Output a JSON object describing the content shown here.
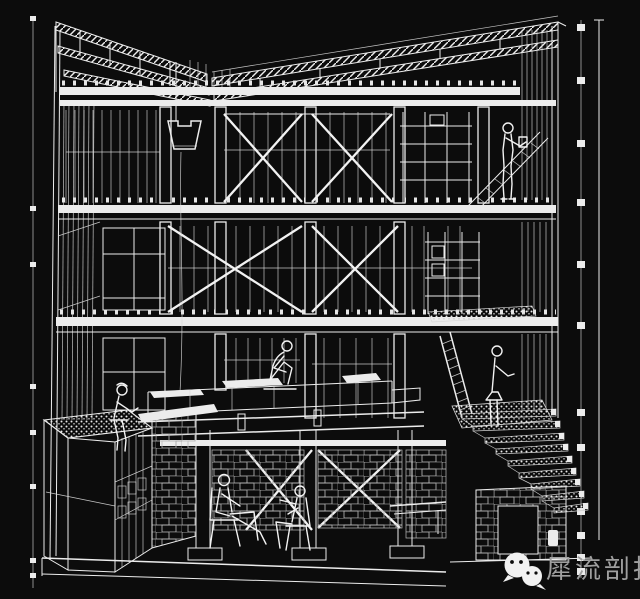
{
  "page": {
    "background_color": "#0c0c0c",
    "line_color": "#ececec"
  },
  "drawing": {
    "type": "architectural-sectional-perspective",
    "description": "White-on-black wireframe sectional perspective of a three-storey timber frame building with basement: butterfly roof trusses, X-braced window bays, hanging planter, central stage platform, green-roof box, ladders, bleacher stair, masonry basement with two seated people and four other human figures, flanked by left and right dimension scale bars"
  },
  "watermark": {
    "text": "犀流剖报",
    "color": "#9f9f9f",
    "icon": "wechat-icon"
  }
}
